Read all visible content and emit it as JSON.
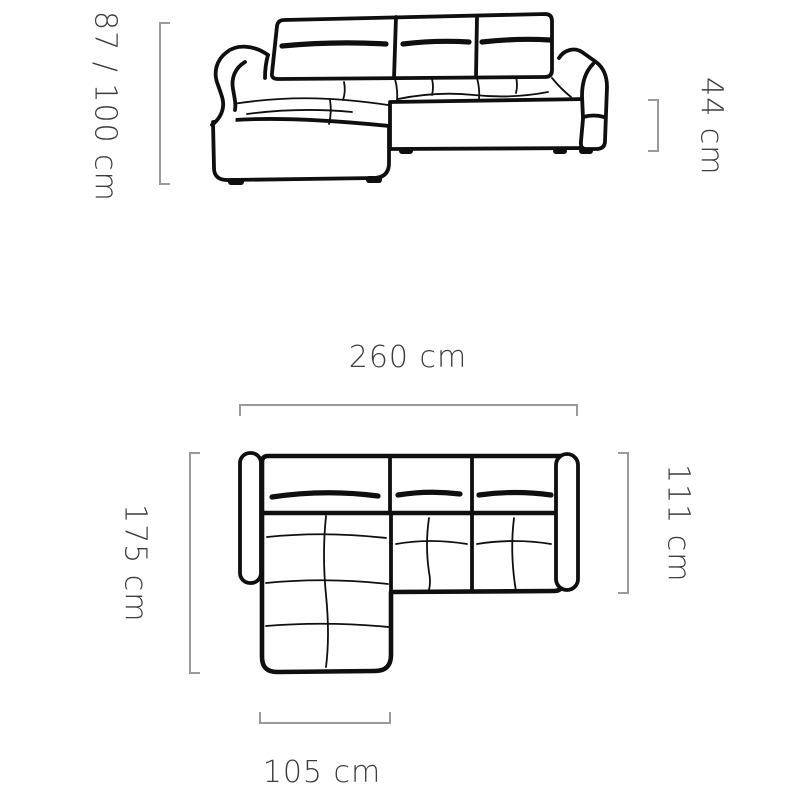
{
  "colors": {
    "line": "#0f0f0f",
    "dimension_bracket": "#9a9a9a",
    "label_text": "#3d3d3d",
    "background": "#ffffff"
  },
  "front_view": {
    "description": "corner sofa front elevation drawing",
    "labels": {
      "overall_height": "87 / 100 cm",
      "seat_height": "44 cm"
    }
  },
  "top_view": {
    "description": "corner sofa top plan drawing",
    "labels": {
      "overall_width": "260 cm",
      "chaise_depth": "175 cm",
      "body_depth": "111 cm",
      "chaise_width": "105 cm"
    }
  }
}
